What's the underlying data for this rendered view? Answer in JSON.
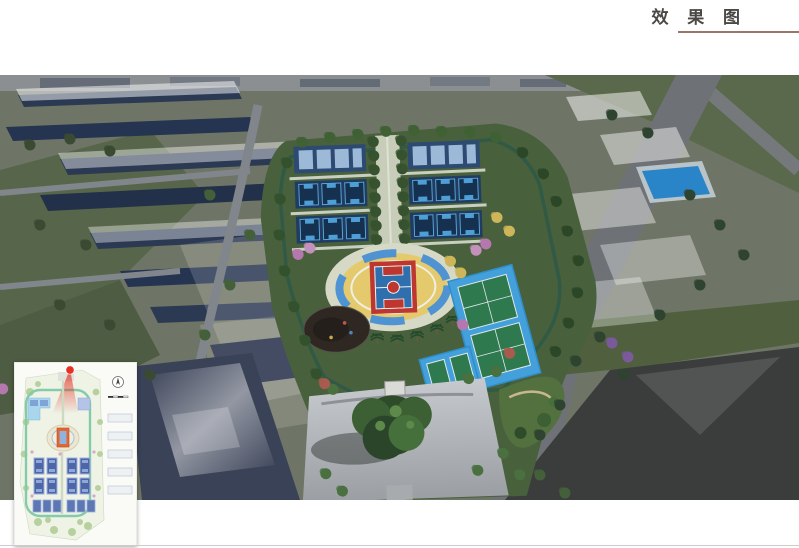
{
  "page": {
    "title": "效 果 图",
    "title_color": "#4b4744",
    "title_underline_color": "#9d7568",
    "background": "#ffffff",
    "bottom_rule_color": "#cccccc"
  },
  "rendering": {
    "kind": "aerial-perspective-rendering",
    "subject": "sports-park-and-surrounding-campus",
    "palette": {
      "land": "#6f7566",
      "field_green": "#57664a",
      "park_green": "#49603c",
      "tree_green": "#3f6134",
      "court_navy": "#203c62",
      "court_light_blue": "#5aaede",
      "center_court_red": "#bd3730",
      "center_court_blue": "#2f6fae",
      "plaza_ring_yellow": "#e5c96d",
      "tennis_green": "#2e7a4e",
      "tennis_apron_blue": "#44a0da",
      "pool_blue": "#2a84c8",
      "plaza_gray": "#b7babd",
      "asphalt_dark": "#3a3d3c",
      "roof_navy": "#2b3953",
      "massing_white": "rgba(255,255,255,0.45)",
      "road_gray": "#7d8288"
    }
  },
  "inset": {
    "kind": "site-plan-key-map",
    "viewpoint_marker_color": "#e43124",
    "icons": [
      "viewpoint-marker",
      "north-compass-icon",
      "scale-bar"
    ]
  }
}
